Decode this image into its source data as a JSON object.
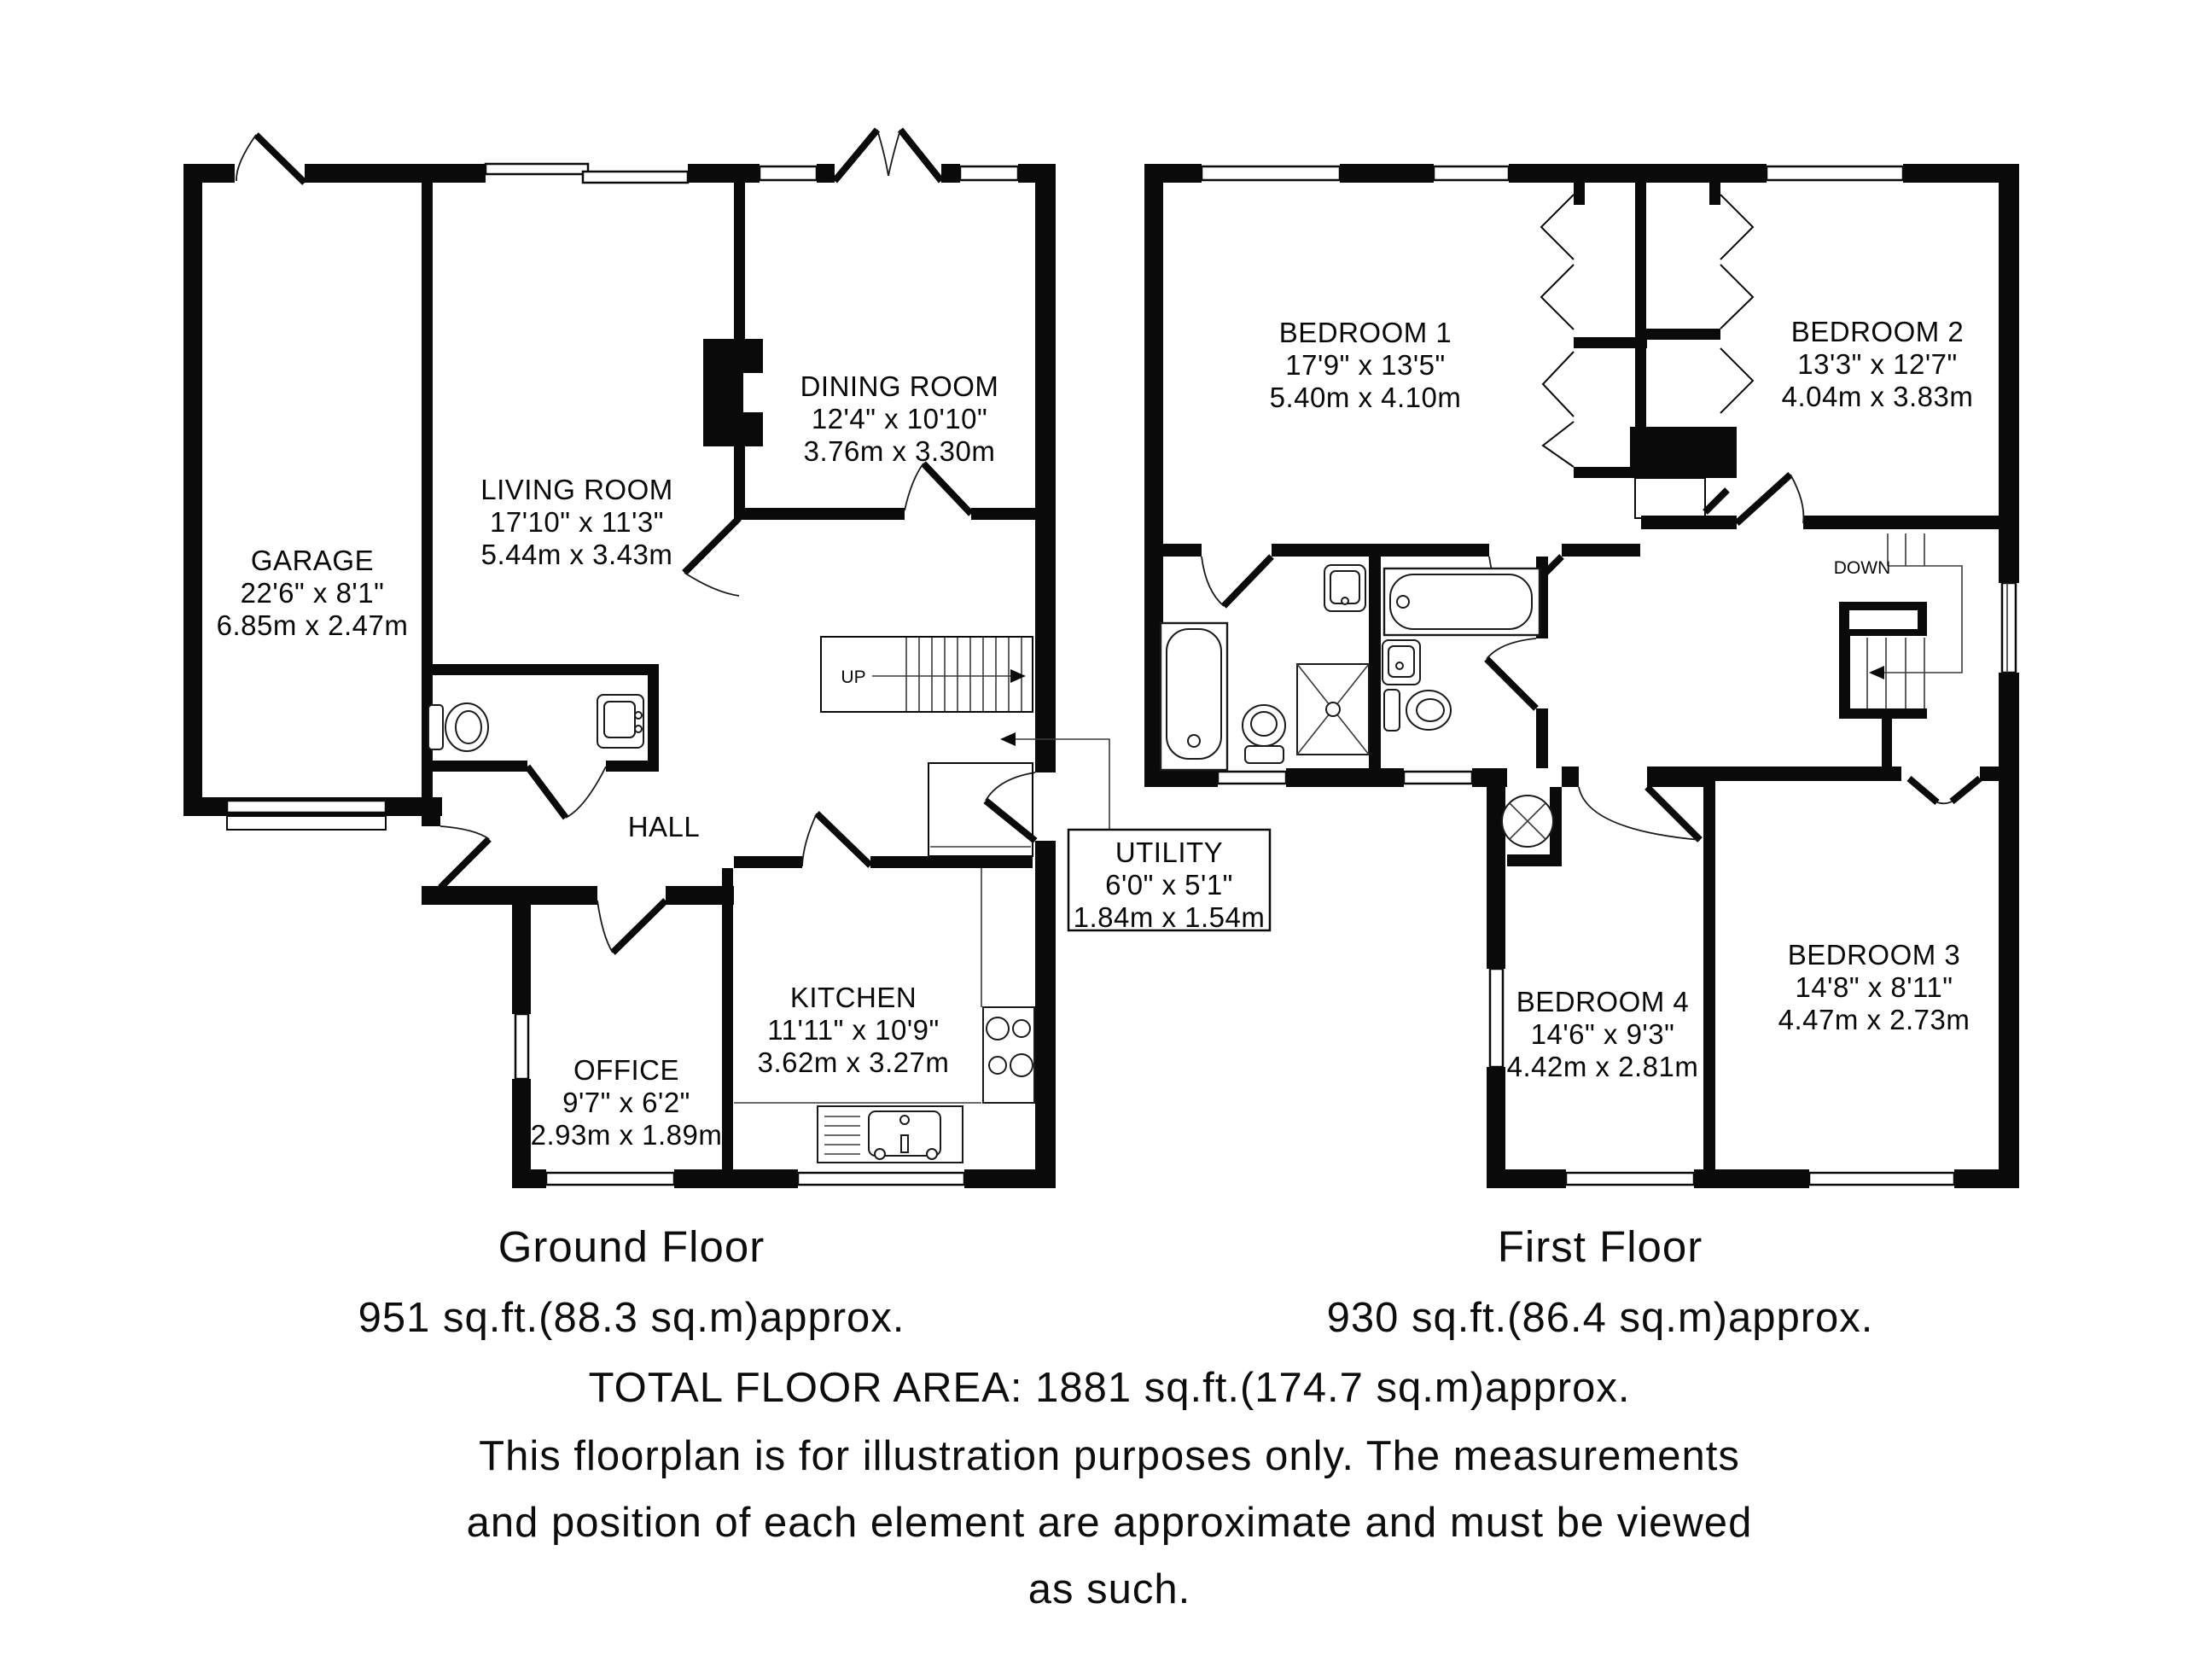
{
  "ground_floor": {
    "stair_label": "UP",
    "garage": {
      "name": "GARAGE",
      "imperial": "22'6\" x 8'1\"",
      "metric": "6.85m x 2.47m"
    },
    "living_room": {
      "name": "LIVING ROOM",
      "imperial": "17'10\" x 11'3\"",
      "metric": "5.44m x 3.43m"
    },
    "dining_room": {
      "name": "DINING ROOM",
      "imperial": "12'4\" x 10'10\"",
      "metric": "3.76m x 3.30m"
    },
    "hall": {
      "name": "HALL"
    },
    "office": {
      "name": "OFFICE",
      "imperial": "9'7\" x 6'2\"",
      "metric": "2.93m x 1.89m"
    },
    "kitchen": {
      "name": "KITCHEN",
      "imperial": "11'11\" x 10'9\"",
      "metric": "3.62m x 3.27m"
    },
    "utility": {
      "name": "UTILITY",
      "imperial": "6'0\" x 5'1\"",
      "metric": "1.84m x 1.54m"
    }
  },
  "first_floor": {
    "stair_label": "DOWN",
    "bedroom1": {
      "name": "BEDROOM 1",
      "imperial": "17'9\" x 13'5\"",
      "metric": "5.40m x 4.10m"
    },
    "bedroom2": {
      "name": "BEDROOM 2",
      "imperial": "13'3\" x 12'7\"",
      "metric": "4.04m x 3.83m"
    },
    "bedroom3": {
      "name": "BEDROOM 3",
      "imperial": "14'8\" x 8'11\"",
      "metric": "4.47m x 2.73m"
    },
    "bedroom4": {
      "name": "BEDROOM 4",
      "imperial": "14'6\" x 9'3\"",
      "metric": "4.42m x 2.81m"
    }
  },
  "footer": {
    "ground_title": "Ground Floor",
    "ground_area": "951 sq.ft.(88.3 sq.m)approx.",
    "first_title": "First Floor",
    "first_area": "930 sq.ft.(86.4 sq.m)approx.",
    "total": "TOTAL FLOOR AREA: 1881 sq.ft.(174.7 sq.m)approx.",
    "disclaimer_line1": "This floorplan is for illustration purposes only. The measurements",
    "disclaimer_line2": "and position of each element are approximate and must be viewed",
    "disclaimer_line3": "as such."
  }
}
